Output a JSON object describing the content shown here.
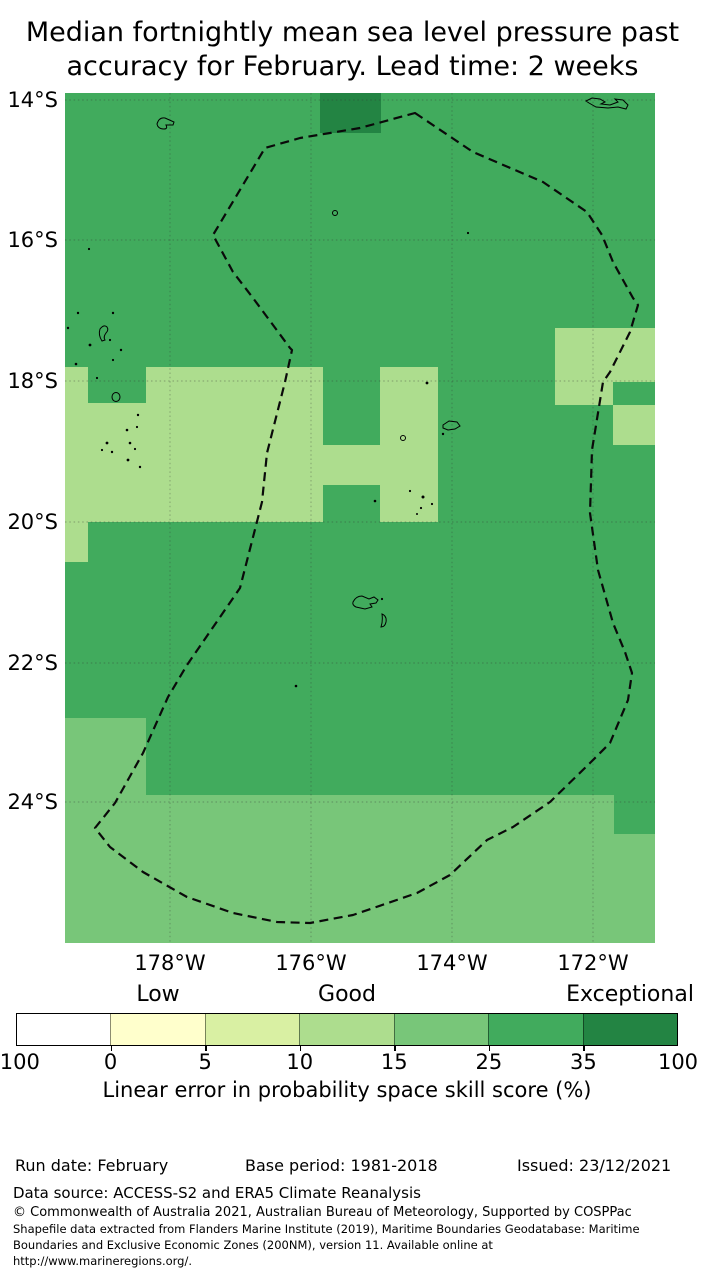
{
  "title": {
    "line1": "Median fortnightly mean sea level pressure past",
    "line2": "accuracy for February. Lead time: 2 weeks"
  },
  "map": {
    "lat_labels": [
      "14°S",
      "16°S",
      "18°S",
      "20°S",
      "22°S",
      "24°S"
    ],
    "lon_labels": [
      "178°W",
      "176°W",
      "174°W",
      "172°W"
    ],
    "colors": {
      "base_green": "#41ab5d",
      "light_green": "#addd8e",
      "midlight_green": "#78c679",
      "dark_green": "#238443",
      "eez_line": "#0a0a0a",
      "grid_line": "#333333"
    },
    "cells": [
      {
        "x": 255,
        "y": 0,
        "w": 61,
        "h": 40,
        "bin": "35-100"
      },
      {
        "x": 0,
        "y": 274,
        "w": 23,
        "h": 195,
        "bin": "10-15"
      },
      {
        "x": 23,
        "y": 310,
        "w": 58,
        "h": 119,
        "bin": "10-15"
      },
      {
        "x": 81,
        "y": 274,
        "w": 177,
        "h": 155,
        "bin": "10-15"
      },
      {
        "x": 258,
        "y": 352,
        "w": 57,
        "h": 40,
        "bin": "10-15"
      },
      {
        "x": 315,
        "y": 274,
        "w": 58,
        "h": 155,
        "bin": "10-15"
      },
      {
        "x": 490,
        "y": 235,
        "w": 100,
        "h": 54,
        "bin": "10-15"
      },
      {
        "x": 490,
        "y": 289,
        "w": 58,
        "h": 23,
        "bin": "10-15"
      },
      {
        "x": 548,
        "y": 312,
        "w": 42,
        "h": 40,
        "bin": "10-15"
      },
      {
        "x": 0,
        "y": 625,
        "w": 81,
        "h": 225,
        "bin": "15-25"
      },
      {
        "x": 81,
        "y": 702,
        "w": 468,
        "h": 148,
        "bin": "15-25"
      },
      {
        "x": 549,
        "y": 741,
        "w": 41,
        "h": 109,
        "bin": "15-25"
      }
    ]
  },
  "colorbar": {
    "band_labels": [
      "Low",
      "Good",
      "Exceptional"
    ],
    "tick_labels": [
      "-100",
      "0",
      "5",
      "10",
      "15",
      "25",
      "35",
      "100"
    ],
    "segment_colors": [
      "#ffffff",
      "#ffffcc",
      "#d9f0a3",
      "#addd8e",
      "#78c679",
      "#41ab5d",
      "#238443"
    ],
    "caption": "Linear error in probability space skill score (%)"
  },
  "footer": {
    "run_date": "Run date: February",
    "base_period": "Base period: 1981-2018",
    "issued": "Issued: 23/12/2021",
    "data_source": "Data source: ACCESS-S2 and ERA5 Climate Reanalysis",
    "copyright": "© Commonwealth of Australia 2021, Australian Bureau of Meteorology, Supported by COSPPac",
    "shapefile_lines": [
      "Shapefile data extracted from Flanders Marine Institute (2019), Maritime Boundaries Geodatabase: Maritime",
      "Boundaries and Exclusive Economic Zones (200NM), version 11. Available online at",
      "http://www.marineregions.org/."
    ]
  },
  "chart_data": {
    "type": "heatmap",
    "title": "Median fortnightly mean sea level pressure past accuracy for February. Lead time: 2 weeks",
    "x_tick_labels": [
      "178°W",
      "176°W",
      "174°W",
      "172°W"
    ],
    "y_tick_labels": [
      "14°S",
      "16°S",
      "18°S",
      "20°S",
      "22°S",
      "24°S"
    ],
    "x_range": "approx 179.5°W to 171.1°W",
    "y_range": "approx 13.9°S to 26.0°S",
    "grid": true,
    "colorbar": {
      "caption": "Linear error in probability space skill score (%)",
      "bin_edges": [
        -100,
        0,
        5,
        10,
        15,
        25,
        35,
        100
      ],
      "bin_colors": [
        "#ffffff",
        "#ffffcc",
        "#d9f0a3",
        "#addd8e",
        "#78c679",
        "#41ab5d",
        "#238443"
      ],
      "qualitative_labels": [
        {
          "label": "Low",
          "over_bin": "0-5"
        },
        {
          "label": "Good",
          "over_bin": "10-15"
        },
        {
          "label": "Exceptional",
          "over_bin": "35-100"
        }
      ]
    },
    "values_by_region": [
      {
        "region": "most of map area",
        "skill_bin_percent": "25-35"
      },
      {
        "region": "one cell top centre near 176°W, 14°S",
        "skill_bin_percent": "35-100"
      },
      {
        "region": "band ~17.9°S-20°S, west and centre",
        "skill_bin_percent": "10-15"
      },
      {
        "region": "block near 172°W, ~17.3°S-18.6°S",
        "skill_bin_percent": "10-15"
      },
      {
        "region": "southern band south of ~24°S",
        "skill_bin_percent": "15-25"
      },
      {
        "region": "southwest block south of ~23°S near 179°W",
        "skill_bin_percent": "15-25"
      }
    ],
    "overlays": [
      "dashed EEZ boundary polygon",
      "island coastline outlines (Lau group, Vava'u, Ha'apai, Tongatapu, Samoa)"
    ]
  }
}
